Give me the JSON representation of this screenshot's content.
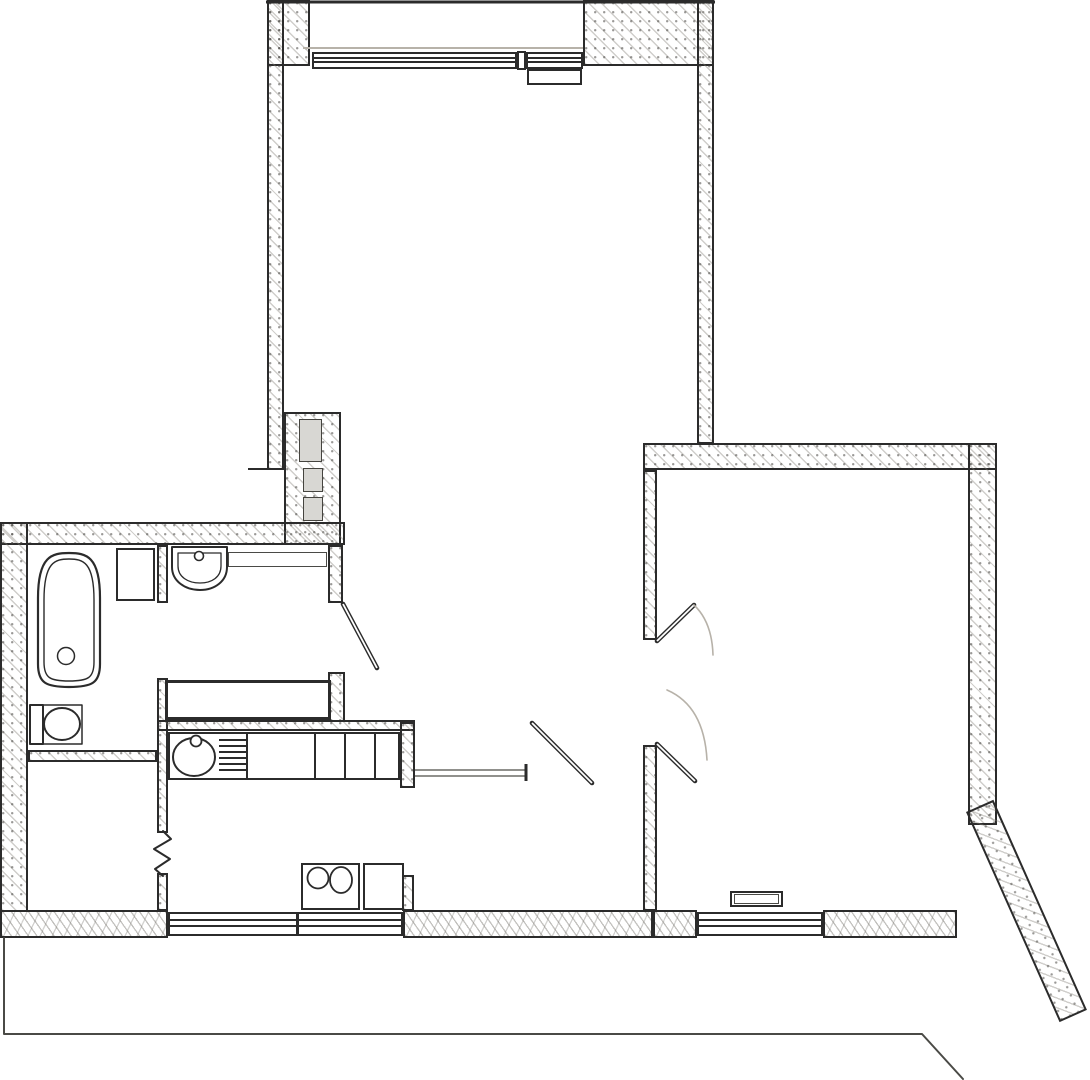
{
  "colors": {
    "ink": "#2b2b2b",
    "mid": "#4a4a46",
    "thin": "#6b6b66",
    "faint": "#b7b2a9"
  },
  "plan": {
    "rects": [
      {
        "name": "balcony-side-wall-left",
        "cls": "wall",
        "x": 267,
        "y": 0,
        "w": 43,
        "h": 66
      },
      {
        "name": "balcony-side-wall-right",
        "cls": "wall",
        "x": 583,
        "y": 0,
        "w": 131,
        "h": 66
      },
      {
        "name": "living-room-left-wall",
        "cls": "wall",
        "x": 267,
        "y": 0,
        "w": 17,
        "h": 470
      },
      {
        "name": "living-room-right-wall",
        "cls": "wall",
        "x": 697,
        "y": 0,
        "w": 17,
        "h": 444
      },
      {
        "name": "vent-shaft-wall-block",
        "cls": "wall",
        "x": 284,
        "y": 412,
        "w": 57,
        "h": 133
      },
      {
        "name": "upper-left-outer-wall",
        "cls": "wall",
        "x": 0,
        "y": 522,
        "w": 345,
        "h": 23
      },
      {
        "name": "left-outer-wall",
        "cls": "wall",
        "x": 0,
        "y": 522,
        "w": 28,
        "h": 390
      },
      {
        "name": "right-room-top-wall",
        "cls": "wall",
        "x": 643,
        "y": 443,
        "w": 354,
        "h": 27
      },
      {
        "name": "right-room-right-wall",
        "cls": "wall",
        "x": 968,
        "y": 443,
        "w": 29,
        "h": 382
      },
      {
        "name": "right-room-diagonal-wall",
        "cls": "wall",
        "x": 966,
        "y": 812,
        "w": 30,
        "h": 230,
        "rot": -24
      },
      {
        "name": "hall-east-wall-upper",
        "cls": "wall",
        "x": 643,
        "y": 470,
        "w": 14,
        "h": 170
      },
      {
        "name": "hall-east-wall-lower",
        "cls": "wall",
        "x": 643,
        "y": 745,
        "w": 14,
        "h": 166
      },
      {
        "name": "wc-east-wall-upper",
        "cls": "wall",
        "x": 328,
        "y": 545,
        "w": 15,
        "h": 58
      },
      {
        "name": "wc-east-wall-stub",
        "cls": "wall",
        "x": 328,
        "y": 672,
        "w": 17,
        "h": 50
      },
      {
        "name": "bath-divider-wall-upper",
        "cls": "wall",
        "x": 157,
        "y": 545,
        "w": 11,
        "h": 58
      },
      {
        "name": "bath-divider-wall-mid",
        "cls": "wall",
        "x": 157,
        "y": 678,
        "w": 11,
        "h": 155
      },
      {
        "name": "bath-divider-wall-lower",
        "cls": "wall",
        "x": 157,
        "y": 873,
        "w": 11,
        "h": 38
      },
      {
        "name": "bath-south-wall",
        "cls": "wall",
        "x": 28,
        "y": 750,
        "w": 129,
        "h": 12
      },
      {
        "name": "kitchen-north-wall",
        "cls": "wall",
        "x": 157,
        "y": 720,
        "w": 258,
        "h": 11
      },
      {
        "name": "kitchen-east-wall-upper",
        "cls": "wall",
        "x": 400,
        "y": 722,
        "w": 15,
        "h": 66
      },
      {
        "name": "kitchen-east-wall-lower",
        "cls": "wall",
        "x": 402,
        "y": 875,
        "w": 12,
        "h": 36
      },
      {
        "name": "bottom-wall-left",
        "cls": "wall-rubble",
        "x": 0,
        "y": 910,
        "w": 168,
        "h": 28
      },
      {
        "name": "bottom-wall-hall",
        "cls": "wall-rubble",
        "x": 403,
        "y": 910,
        "w": 250,
        "h": 28
      },
      {
        "name": "bottom-wall-right-a",
        "cls": "wall-rubble",
        "x": 653,
        "y": 910,
        "w": 44,
        "h": 28
      },
      {
        "name": "bottom-wall-right-b",
        "cls": "wall-rubble",
        "x": 823,
        "y": 910,
        "w": 134,
        "h": 28
      },
      {
        "name": "vent-duct-large",
        "cls": "vent",
        "x": 299,
        "y": 419,
        "w": 23,
        "h": 43
      },
      {
        "name": "vent-duct-mid",
        "cls": "vent",
        "x": 303,
        "y": 468,
        "w": 20,
        "h": 24
      },
      {
        "name": "vent-duct-small",
        "cls": "vent",
        "x": 303,
        "y": 497,
        "w": 20,
        "h": 24
      },
      {
        "name": "balcony-window-left",
        "cls": "window",
        "x": 312,
        "y": 52,
        "w": 205,
        "h": 17
      },
      {
        "name": "balcony-window-mullion",
        "cls": "jamb",
        "x": 517,
        "y": 51,
        "w": 9,
        "h": 19
      },
      {
        "name": "balcony-window-right",
        "cls": "window",
        "x": 526,
        "y": 52,
        "w": 57,
        "h": 17
      },
      {
        "name": "balcony-door-leaf",
        "cls": "box",
        "x": 527,
        "y": 69,
        "w": 55,
        "h": 16
      },
      {
        "name": "kitchen-window",
        "cls": "window",
        "x": 168,
        "y": 912,
        "w": 235,
        "h": 24
      },
      {
        "name": "kitchen-window-mullion",
        "cls": "ink-v",
        "x": 296,
        "y": 912,
        "w": 3,
        "h": 24
      },
      {
        "name": "right-room-window",
        "cls": "window",
        "x": 697,
        "y": 912,
        "w": 126,
        "h": 24
      },
      {
        "name": "washing-machine",
        "cls": "box",
        "x": 116,
        "y": 548,
        "w": 39,
        "h": 53
      },
      {
        "name": "wc-shelf",
        "cls": "thinbox",
        "x": 228,
        "y": 552,
        "w": 99,
        "h": 15
      },
      {
        "name": "utility-shaft-box",
        "cls": "shaftbox",
        "x": 165,
        "y": 680,
        "w": 166,
        "h": 40
      },
      {
        "name": "kitchen-counter",
        "cls": "box",
        "x": 168,
        "y": 732,
        "w": 232,
        "h": 48
      },
      {
        "name": "counter-divider-1",
        "cls": "ink-v",
        "x": 246,
        "y": 734,
        "w": 2,
        "h": 45
      },
      {
        "name": "counter-divider-2",
        "cls": "ink-v",
        "x": 314,
        "y": 734,
        "w": 2,
        "h": 45
      },
      {
        "name": "counter-divider-3",
        "cls": "ink-v",
        "x": 344,
        "y": 734,
        "w": 2,
        "h": 45
      },
      {
        "name": "counter-divider-4",
        "cls": "ink-v",
        "x": 374,
        "y": 734,
        "w": 2,
        "h": 45
      },
      {
        "name": "drainboard-bar-1",
        "cls": "ink-h",
        "x": 219,
        "y": 739,
        "w": 28,
        "h": 2
      },
      {
        "name": "drainboard-bar-2",
        "cls": "ink-h",
        "x": 219,
        "y": 745,
        "w": 28,
        "h": 2
      },
      {
        "name": "drainboard-bar-3",
        "cls": "ink-h",
        "x": 219,
        "y": 751,
        "w": 28,
        "h": 2
      },
      {
        "name": "drainboard-bar-4",
        "cls": "ink-h",
        "x": 219,
        "y": 757,
        "w": 28,
        "h": 2
      },
      {
        "name": "drainboard-bar-5",
        "cls": "ink-h",
        "x": 219,
        "y": 763,
        "w": 28,
        "h": 2
      },
      {
        "name": "drainboard-bar-6",
        "cls": "ink-h",
        "x": 219,
        "y": 769,
        "w": 28,
        "h": 2
      },
      {
        "name": "stove-burner-unit",
        "cls": "box",
        "x": 301,
        "y": 863,
        "w": 59,
        "h": 47
      },
      {
        "name": "stove-side-unit",
        "cls": "box",
        "x": 363,
        "y": 863,
        "w": 41,
        "h": 47
      },
      {
        "name": "radiator",
        "cls": "box",
        "x": 730,
        "y": 891,
        "w": 53,
        "h": 16
      },
      {
        "name": "radiator-inner",
        "cls": "thinbox",
        "x": 734,
        "y": 894,
        "w": 45,
        "h": 10
      }
    ],
    "shapes": [
      {
        "name": "balcony-outer-edge",
        "type": "line",
        "x1": 266,
        "y1": 2,
        "x2": 715,
        "y2": 2,
        "sw": 3
      },
      {
        "name": "window-sill-line",
        "type": "line",
        "x1": 303,
        "y1": 48,
        "x2": 583,
        "y2": 48,
        "sw": 2,
        "cls": "faint"
      },
      {
        "name": "wall-step-line",
        "type": "line",
        "x1": 248,
        "y1": 469,
        "x2": 267,
        "y2": 469,
        "sw": 2
      },
      {
        "name": "bathtub-outer",
        "type": "path",
        "d": "M38,598 C38,556 52,553 69,553 C86,553 100,556 100,598 L100,664 C100,683 92,687 69,687 C46,687 38,683 38,664 Z",
        "fill": "#fff",
        "sw": 2.2
      },
      {
        "name": "bathtub-inner",
        "type": "path",
        "d": "M44,600 C44,562 55,559 69,559 C83,559 94,562 94,600 L94,662 C94,678 88,681 69,681 C50,681 44,678 44,662 Z",
        "sw": 1.4
      },
      {
        "name": "bathtub-drain",
        "type": "circle",
        "cx": 66,
        "cy": 656,
        "r": 8.5,
        "sw": 1.5
      },
      {
        "name": "toilet-frame",
        "type": "path",
        "d": "M30,705 H82 V744 H30 Z",
        "sw": 1.5
      },
      {
        "name": "toilet-tank",
        "type": "path",
        "d": "M30,705 H43 V744 H30 Z",
        "fill": "#fff",
        "sw": 2
      },
      {
        "name": "toilet-bowl",
        "type": "ellipse",
        "cx": 62,
        "cy": 724,
        "rx": 18,
        "ry": 16,
        "fill": "#fff",
        "sw": 2
      },
      {
        "name": "wc-sink-outer",
        "type": "path",
        "d": "M172,547 H227 V567 C227,581 215,590 200,590 C185,590 172,581 172,567 Z",
        "fill": "#fff",
        "sw": 2
      },
      {
        "name": "wc-sink-inner",
        "type": "path",
        "d": "M178,553 H221 V566 C221,577 212,583 200,583 C188,583 178,577 178,566 Z",
        "sw": 1.3
      },
      {
        "name": "wc-sink-faucet",
        "type": "circle",
        "cx": 199,
        "cy": 556,
        "r": 4.5,
        "fill": "#fff",
        "sw": 1.6
      },
      {
        "name": "kitchen-sink",
        "type": "ellipse",
        "cx": 194,
        "cy": 757,
        "rx": 21,
        "ry": 19,
        "fill": "#fff",
        "sw": 2
      },
      {
        "name": "kitchen-sink-faucet",
        "type": "circle",
        "cx": 196,
        "cy": 741,
        "r": 5.5,
        "fill": "#fff",
        "sw": 1.8
      },
      {
        "name": "stove-burner-left",
        "type": "circle",
        "cx": 318,
        "cy": 878,
        "r": 10.5,
        "fill": "#fff",
        "sw": 1.8
      },
      {
        "name": "stove-burner-right",
        "type": "ellipse",
        "cx": 341,
        "cy": 880,
        "rx": 11,
        "ry": 13,
        "fill": "#fff",
        "sw": 1.8
      },
      {
        "name": "wc-door-leaf",
        "type": "dline",
        "x1": 343,
        "y1": 604,
        "x2": 377,
        "y2": 668
      },
      {
        "name": "hall-door-leaf",
        "type": "dline",
        "x1": 532,
        "y1": 723,
        "x2": 592,
        "y2": 783
      },
      {
        "name": "right-room-door-leaf-upper",
        "type": "dline",
        "x1": 657,
        "y1": 641,
        "x2": 694,
        "y2": 605
      },
      {
        "name": "right-room-door-leaf-lower",
        "type": "dline",
        "x1": 657,
        "y1": 744,
        "x2": 695,
        "y2": 781
      },
      {
        "name": "kitchen-threshold-top",
        "type": "line",
        "x1": 415,
        "y1": 770,
        "x2": 527,
        "y2": 770,
        "sw": 1.6,
        "cls": "thin"
      },
      {
        "name": "kitchen-threshold-bottom",
        "type": "line",
        "x1": 415,
        "y1": 776,
        "x2": 527,
        "y2": 776,
        "sw": 1.6,
        "cls": "thin"
      },
      {
        "name": "kitchen-threshold-end",
        "type": "line",
        "x1": 526,
        "y1": 764,
        "x2": 526,
        "y2": 781,
        "sw": 3
      },
      {
        "name": "door-swing-arc-upper",
        "type": "path",
        "d": "M694,605 Q712,622 713,655",
        "sw": 1.6,
        "cls": "faint"
      },
      {
        "name": "door-swing-arc-lower",
        "type": "path",
        "d": "M667,690 Q704,706 707,760",
        "sw": 1.6,
        "cls": "faint"
      },
      {
        "name": "wall-break-zigzag",
        "type": "path",
        "d": "M163,831 L171,839 L154,849 L170,859 L155,869 L163,876",
        "sw": 2
      },
      {
        "name": "terrace-outline",
        "type": "path",
        "d": "M4,938 L4,1034 L922,1034 L963,1079",
        "sw": 2,
        "cls": "mid"
      }
    ]
  }
}
